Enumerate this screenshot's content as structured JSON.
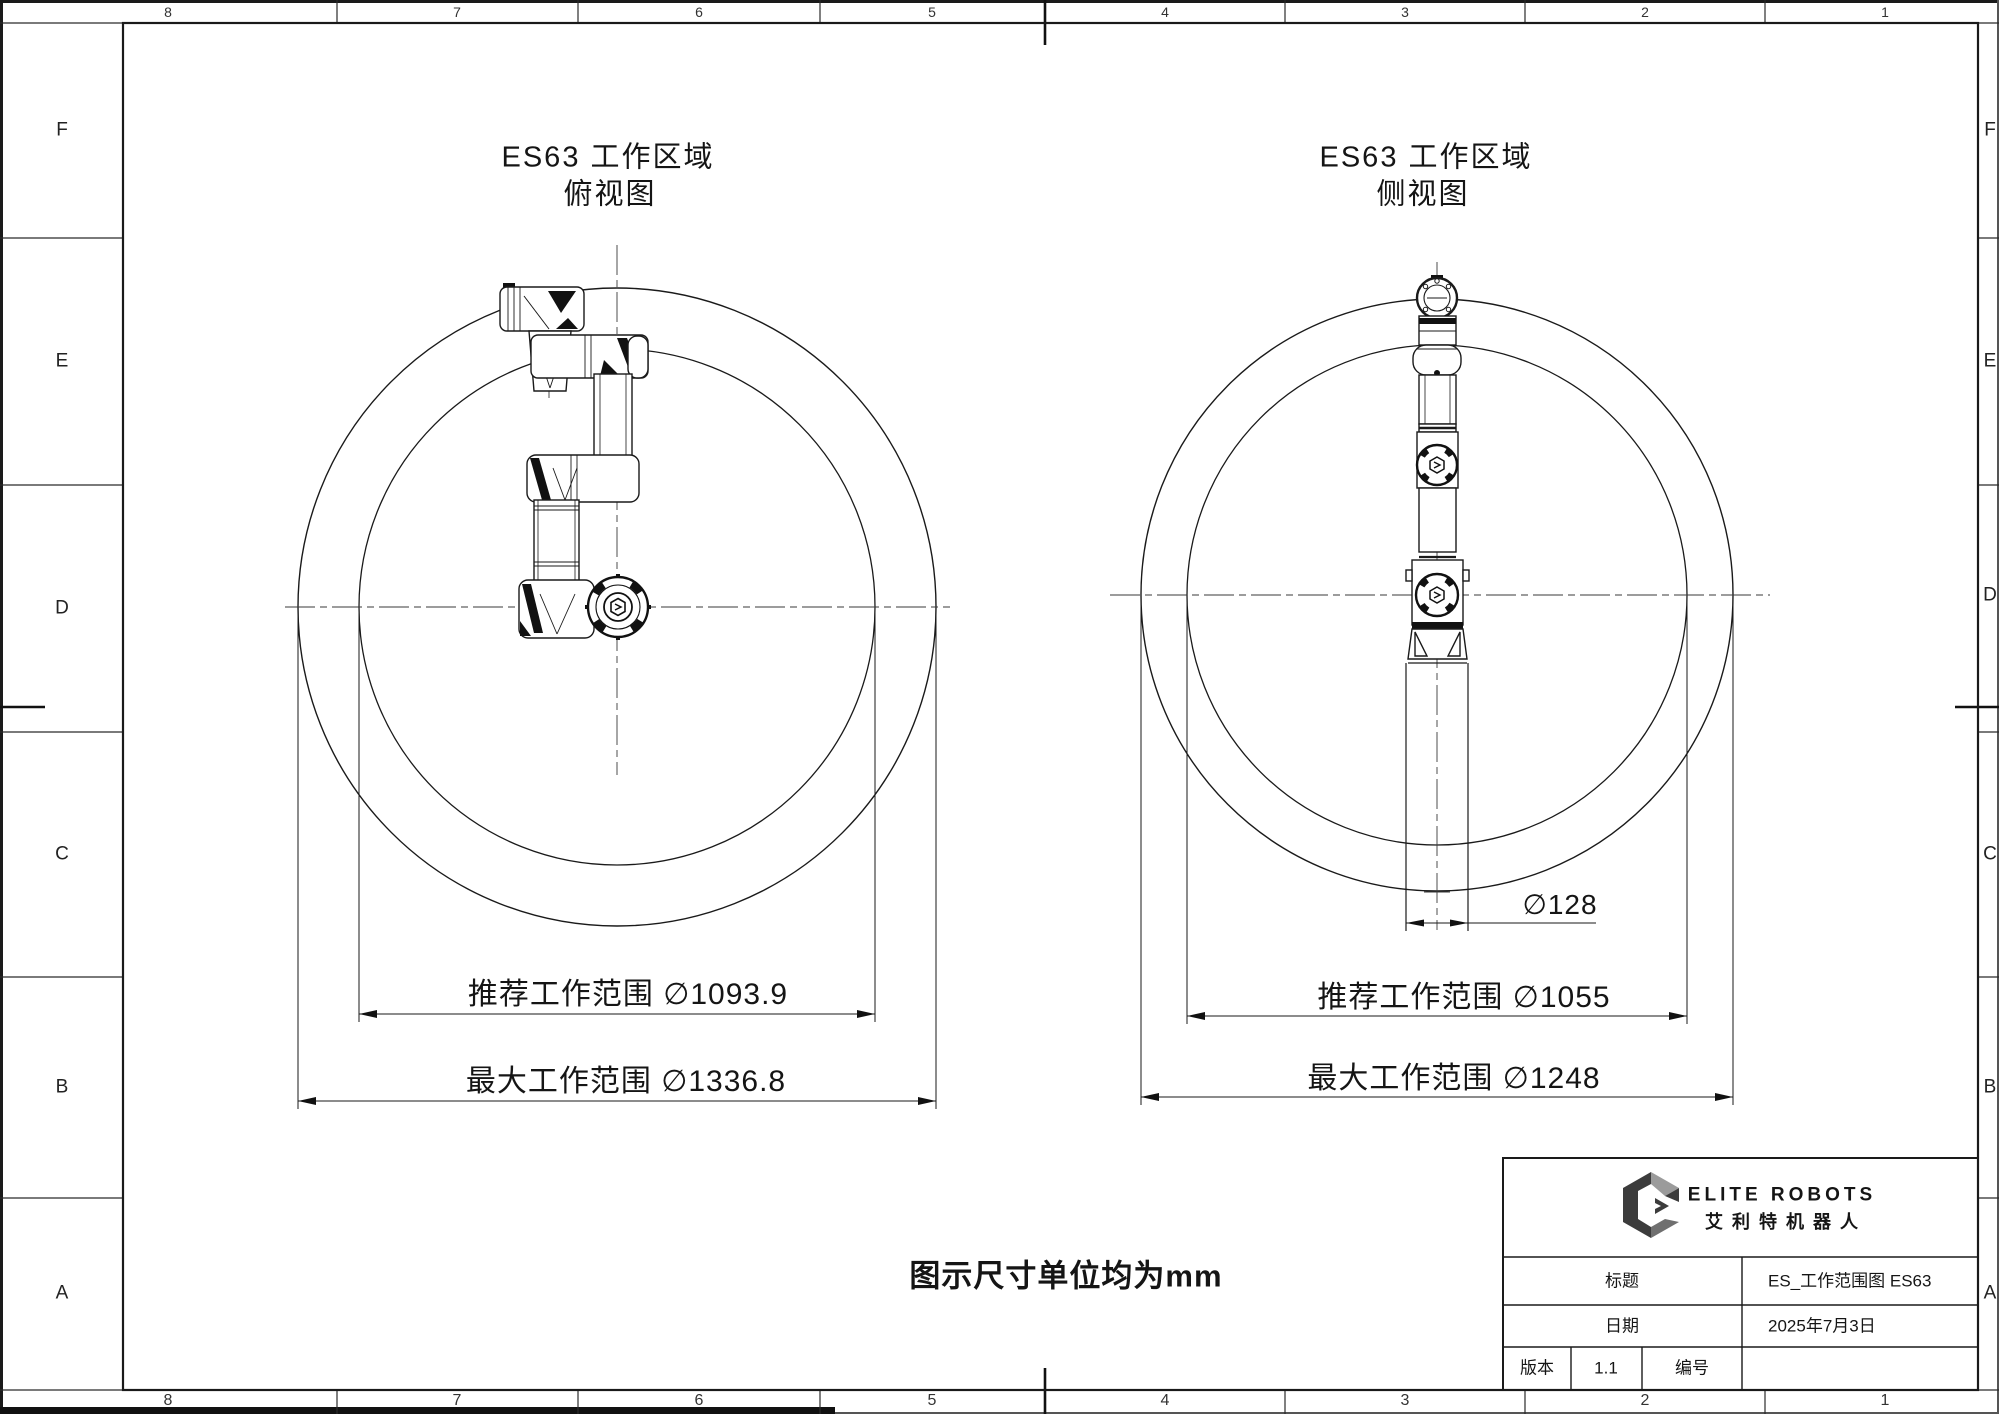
{
  "sheet": {
    "grid_cols_top": [
      "8",
      "7",
      "6",
      "5",
      "4",
      "3",
      "2",
      "1"
    ],
    "grid_cols_bottom": [
      "8",
      "7",
      "6",
      "5",
      "4",
      "3",
      "2",
      "1"
    ],
    "grid_rows_left": [
      "F",
      "E",
      "D",
      "C",
      "B",
      "A"
    ],
    "grid_rows_right": [
      "F",
      "E",
      "D",
      "C",
      "B",
      "A"
    ],
    "units_note": "图示尺寸单位均为mm"
  },
  "views": {
    "top": {
      "title": "ES63 工作区域",
      "subtitle": "俯视图",
      "dim_recommended": "推荐工作范围 ∅1093.9",
      "dim_maximum": "最大工作范围 ∅1336.8"
    },
    "side": {
      "title": "ES63 工作区域",
      "subtitle": "侧视图",
      "dim_recommended": "推荐工作范围 ∅1055",
      "dim_maximum": "最大工作范围 ∅1248",
      "dim_base": "∅128"
    }
  },
  "dimensions_mm": {
    "unit": "mm",
    "top_view": {
      "recommended_diameter": 1093.9,
      "maximum_diameter": 1336.8
    },
    "side_view": {
      "recommended_diameter": 1055,
      "maximum_diameter": 1248,
      "base_diameter": 128
    },
    "robot_model": "ES63"
  },
  "title_block": {
    "brand": {
      "logo_icon": "elite-robots-cube-logo",
      "name_en": "ELITE ROBOTS",
      "name_cn": "艾利特机器人"
    },
    "title_label": "标题",
    "title_value": "ES_工作范围图 ES63",
    "date_label": "日期",
    "date_value": "2025年7月3日",
    "version_label": "版本",
    "version_value": "1.1",
    "number_label": "编号",
    "number_value": ""
  }
}
